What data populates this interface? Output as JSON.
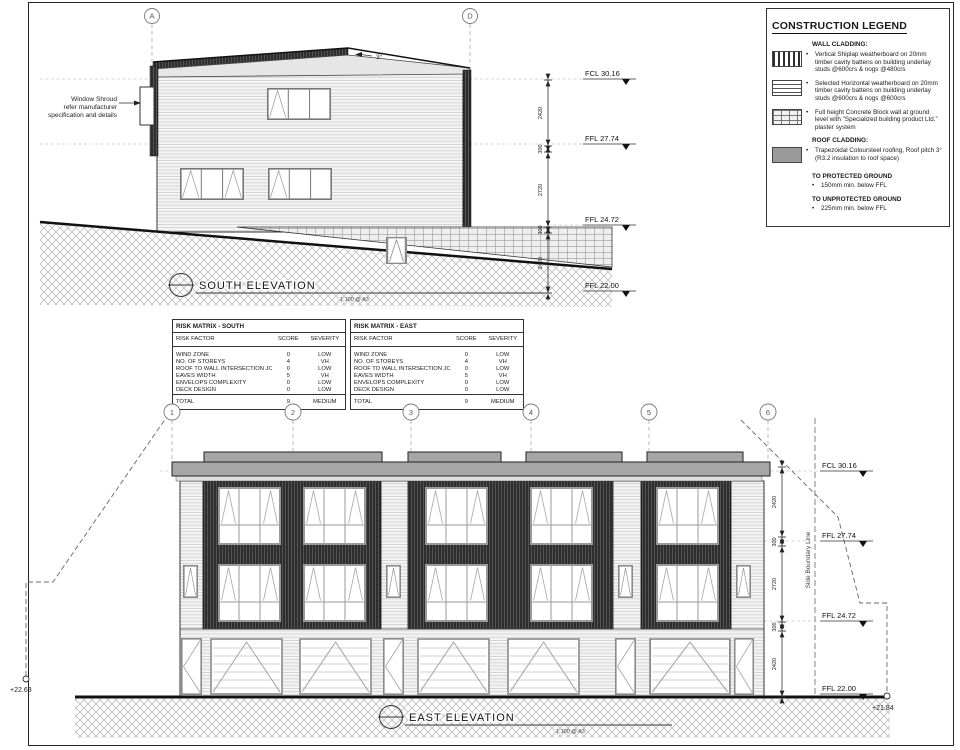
{
  "legend": {
    "title": "CONSTRUCTION LEGEND",
    "wall_heading": "WALL CLADDING:",
    "wall_items": [
      "Vertical Shiplap weatherboard on 20mm timber cavity battens on building underlay studs @600crs & nogs @480crs",
      "Selected Horizontal weatherboard on 20mm timber cavity battens on building underlay studs @600crs & nogs @600crs",
      "Full height Concrete Block wall at ground level with \"Specialized building product Ltd.\" plaster system"
    ],
    "roof_heading": "ROOF CLADDING:",
    "roof_items": [
      "Trapezoidal Coloursteel roofing, Roof pitch 3° (R3.2 insulation to roof space)"
    ],
    "protected_heading": "TO PROTECTED GROUND",
    "protected_item": "150mm min. below FFL",
    "unprotected_heading": "TO UNPROTECTED GROUND",
    "unprotected_item": "225mm min. below FFL"
  },
  "risk_matrices": [
    {
      "title": "RISK MATRIX - SOUTH",
      "col_factor": "RISK FACTOR",
      "col_score": "SCORE",
      "col_severity": "SEVERITY",
      "rows": [
        {
          "factor": "WIND ZONE",
          "score": "0",
          "severity": "LOW"
        },
        {
          "factor": "NO. OF STOREYS",
          "score": "4",
          "severity": "VH"
        },
        {
          "factor": "ROOF TO WALL INTERSECTION JOINT",
          "score": "0",
          "severity": "LOW"
        },
        {
          "factor": "EAVES WIDTH",
          "score": "5",
          "severity": "VH"
        },
        {
          "factor": "ENVELOPS COMPLEXITY",
          "score": "0",
          "severity": "LOW"
        },
        {
          "factor": "DECK DESIGN",
          "score": "0",
          "severity": "LOW"
        }
      ],
      "total_label": "TOTAL",
      "total_score": "9",
      "total_severity": "MEDIUM"
    },
    {
      "title": "RISK MATRIX - EAST",
      "col_factor": "RISK FACTOR",
      "col_score": "SCORE",
      "col_severity": "SEVERITY",
      "rows": [
        {
          "factor": "WIND ZONE",
          "score": "0",
          "severity": "LOW"
        },
        {
          "factor": "NO. OF STOREYS",
          "score": "4",
          "severity": "VH"
        },
        {
          "factor": "ROOF TO WALL INTERSECTION JOINT",
          "score": "0",
          "severity": "LOW"
        },
        {
          "factor": "EAVES WIDTH",
          "score": "5",
          "severity": "VH"
        },
        {
          "factor": "ENVELOPS COMPLEXITY",
          "score": "0",
          "severity": "LOW"
        },
        {
          "factor": "DECK DESIGN",
          "score": "0",
          "severity": "LOW"
        }
      ],
      "total_label": "TOTAL",
      "total_score": "9",
      "total_severity": "MEDIUM"
    }
  ],
  "south_elevation": {
    "title": "SOUTH ELEVATION",
    "scale": "1:100 @ A3",
    "grid_markers": [
      "A",
      "D"
    ],
    "roof_pitch": "3°",
    "annotation_lines": [
      "Window Shroud",
      "refer manufacturer",
      "specification and details"
    ],
    "levels": [
      "FCL 30.16",
      "FFL 27.74",
      "FFL 24.72",
      "FFL 22.00"
    ],
    "dims": [
      "2420",
      "300",
      "2720",
      "300",
      "2420"
    ]
  },
  "east_elevation": {
    "title": "EAST ELEVATION",
    "scale": "1:100 @ A3",
    "grid_markers": [
      "1",
      "2",
      "3",
      "4",
      "5",
      "6"
    ],
    "levels": [
      "FCL 30.16",
      "FFL 27.74",
      "FFL 24.72",
      "FFL 22.00"
    ],
    "dims": [
      "2420",
      "300",
      "2720",
      "300",
      "2420"
    ],
    "spot_left": "+22.63",
    "spot_right": "+21.84",
    "boundary_label": "Side Boundary Line"
  }
}
